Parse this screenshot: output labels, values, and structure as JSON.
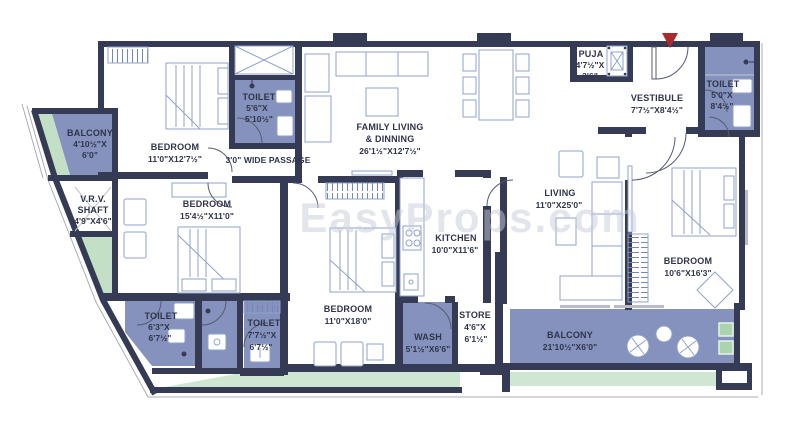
{
  "watermark": "EasyProps.com",
  "colors": {
    "wall": "#353b54",
    "wet_area": "#8492bd",
    "garden_green": "#cfe7d2",
    "planter_green": "#a9d4ae",
    "furniture_line": "#8fa2ca",
    "label_text": "#2f3449",
    "entry_arrow": "#a82c2c",
    "sill_gray": "#b9bdc9"
  },
  "rooms": {
    "balcony_left": {
      "name": "BALCONY",
      "dims1": "4'10½\"X",
      "dims2": "6'0\""
    },
    "bedroom_1": {
      "name": "BEDROOM",
      "dims": "11'0\"X12'7½\""
    },
    "toilet_1": {
      "name": "TOILET",
      "dims1": "5'6\"X",
      "dims2": "5'10½\""
    },
    "passage": {
      "name": "3'0\" WIDE PASSAGE"
    },
    "family_living": {
      "name": "FAMILY LIVING",
      "name2": "& DINNING",
      "dims": "26'1½\"X12'7½\""
    },
    "puja": {
      "name": "PUJA",
      "dims1": "4'7½\"X",
      "dims2": "3'6\""
    },
    "vestibule": {
      "name": "VESTIBULE",
      "dims": "7'7½\"X8'4½\""
    },
    "toilet_2": {
      "name": "TOILET",
      "dims1": "5'0\"X",
      "dims2": "8'4½\""
    },
    "vrv_shaft": {
      "name": "V.R.V.",
      "name2": "SHAFT",
      "dims": "4'9\"X4'6\""
    },
    "bedroom_2": {
      "name": "BEDROOM",
      "dims": "15'4½\"X11'0\""
    },
    "kitchen": {
      "name": "KITCHEN",
      "dims": "10'0\"X11'6\""
    },
    "living": {
      "name": "LIVING",
      "dims": "11'0\"X25'0\""
    },
    "bedroom_3": {
      "name": "BEDROOM",
      "dims": "11'0\"X18'0\""
    },
    "bedroom_4": {
      "name": "BEDROOM",
      "dims": "10'6\"X16'3\""
    },
    "toilet_3": {
      "name": "TOILET",
      "dims1": "6'3\"X",
      "dims2": "6'7½\""
    },
    "toilet_4": {
      "name": "TOILET",
      "dims1": "7'7½\"X",
      "dims2": "6'7½\""
    },
    "wash": {
      "name": "WASH",
      "dims": "5'1½\"X6'6\""
    },
    "store": {
      "name": "STORE",
      "dims1": "4'6\"X",
      "dims2": "6'1½\""
    },
    "balcony_main": {
      "name": "BALCONY",
      "dims": "21'10½\"X6'0\""
    }
  }
}
